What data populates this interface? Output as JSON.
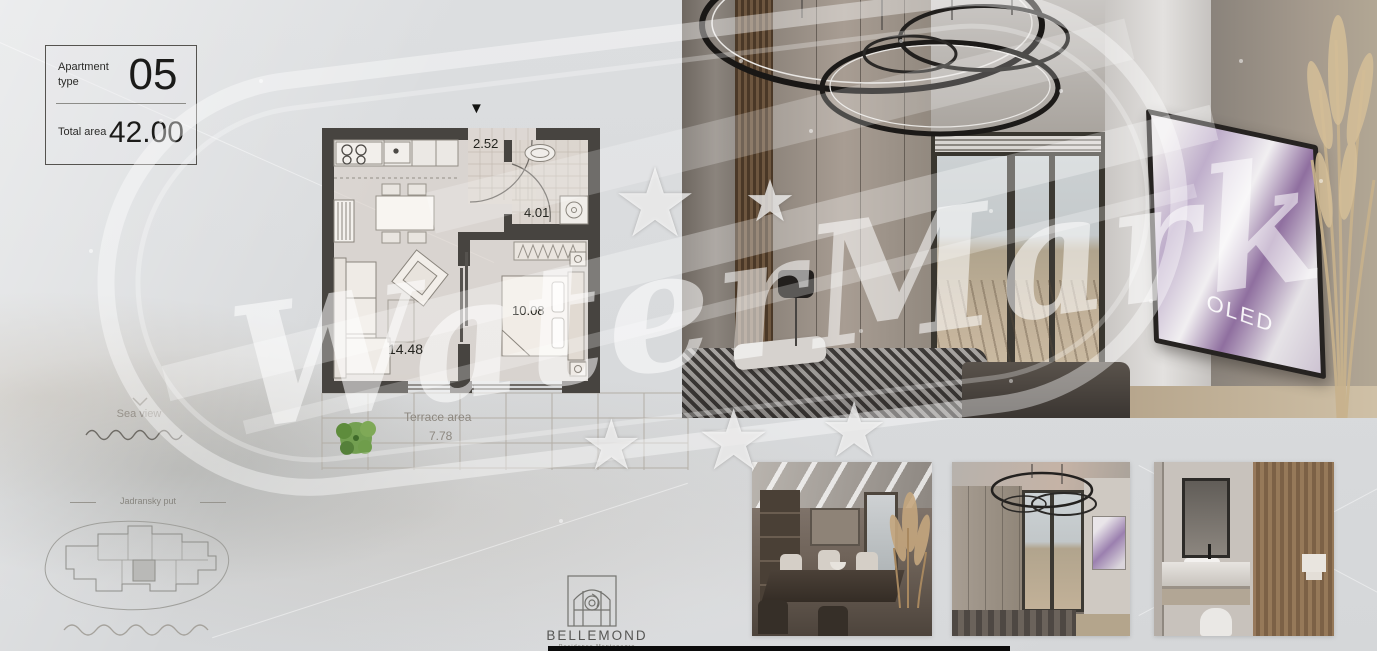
{
  "info_card": {
    "apartment_type_label": "Apartment type",
    "apartment_type_value": "05",
    "total_area_label": "Total area",
    "total_area_value": "42.00"
  },
  "floor_plan": {
    "entrance_marker": "▼",
    "rooms": [
      {
        "name": "hall",
        "area": "2.52"
      },
      {
        "name": "bathroom",
        "area": "4.01"
      },
      {
        "name": "bedroom",
        "area": "10.08"
      },
      {
        "name": "living-room-kitchen",
        "area": "14.48"
      }
    ],
    "terrace": {
      "label": "Terrace area",
      "area": "7.78"
    }
  },
  "annotations": {
    "sea_view_label": "Sea view",
    "road_label": "Jadransky put"
  },
  "brand": {
    "logo_text": "BELLEMOND",
    "logo_subtitle": "Residence Montenegro"
  },
  "watermark": {
    "text": "WaterMark",
    "star_glyph": "★"
  },
  "main_photo": {
    "tv_screen_text": "OLED"
  },
  "colors": {
    "background": "#d9dbdd",
    "plan_wall": "#474440",
    "tree_green": "#6f9d4b",
    "watermark_white": "rgba(255,255,255,0.5)",
    "tv_screen_accent": "#9a7fae",
    "logo_gray": "#565654"
  }
}
